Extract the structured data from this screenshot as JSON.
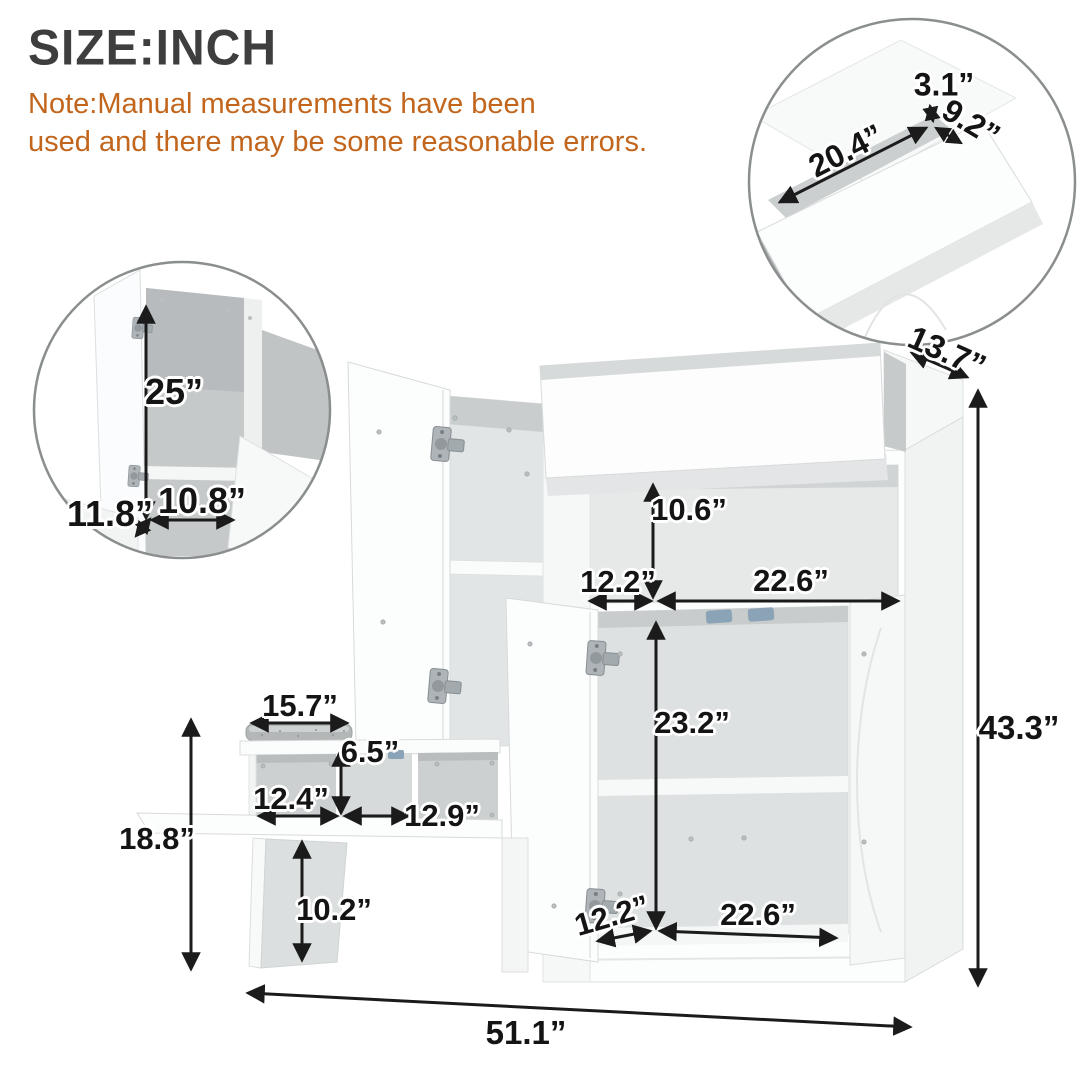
{
  "title": "SIZE:INCH",
  "note": {
    "line1": "Note:Manual measurements have been",
    "line2": "used and there may be some reasonable errors."
  },
  "colors": {
    "title_text": "#3E3E3E",
    "note_text": "#C2661D",
    "dimension_text": "#141414",
    "arrow": "#1B1B1B",
    "inset_outline": "#8B8E8F",
    "furniture_outline": "#D8DBDB",
    "interior_shade": "#DEE1E1",
    "cushion": "#B3B7B8",
    "hardware_blue": "#8BA3B6"
  },
  "dimensions": {
    "top_depth": "13.7”",
    "total_height": "43.3”",
    "upper_opening_height": "10.6”",
    "upper_opening_left_width": "12.2”",
    "upper_opening_right_width": "22.6”",
    "door_opening_height": "23.2”",
    "lower_opening_left_width": "12.2”",
    "lower_opening_right_width": "22.6”",
    "seat_top_width": "15.7”",
    "cubby_height": "6.5”",
    "cubby_left_width": "12.4”",
    "cubby_right_width": "12.9”",
    "seat_section_height": "18.8”",
    "leg_clearance_height": "10.2”",
    "total_width": "51.1”"
  },
  "inset_cabinet_interior": {
    "door_inner_height": "25”",
    "inner_width": "10.8”",
    "inner_depth": "11.8”"
  },
  "inset_drawer_detail": {
    "drawer_length": "20.4”",
    "rail_gap": "3.1”",
    "drawer_depth": "9.2”"
  }
}
